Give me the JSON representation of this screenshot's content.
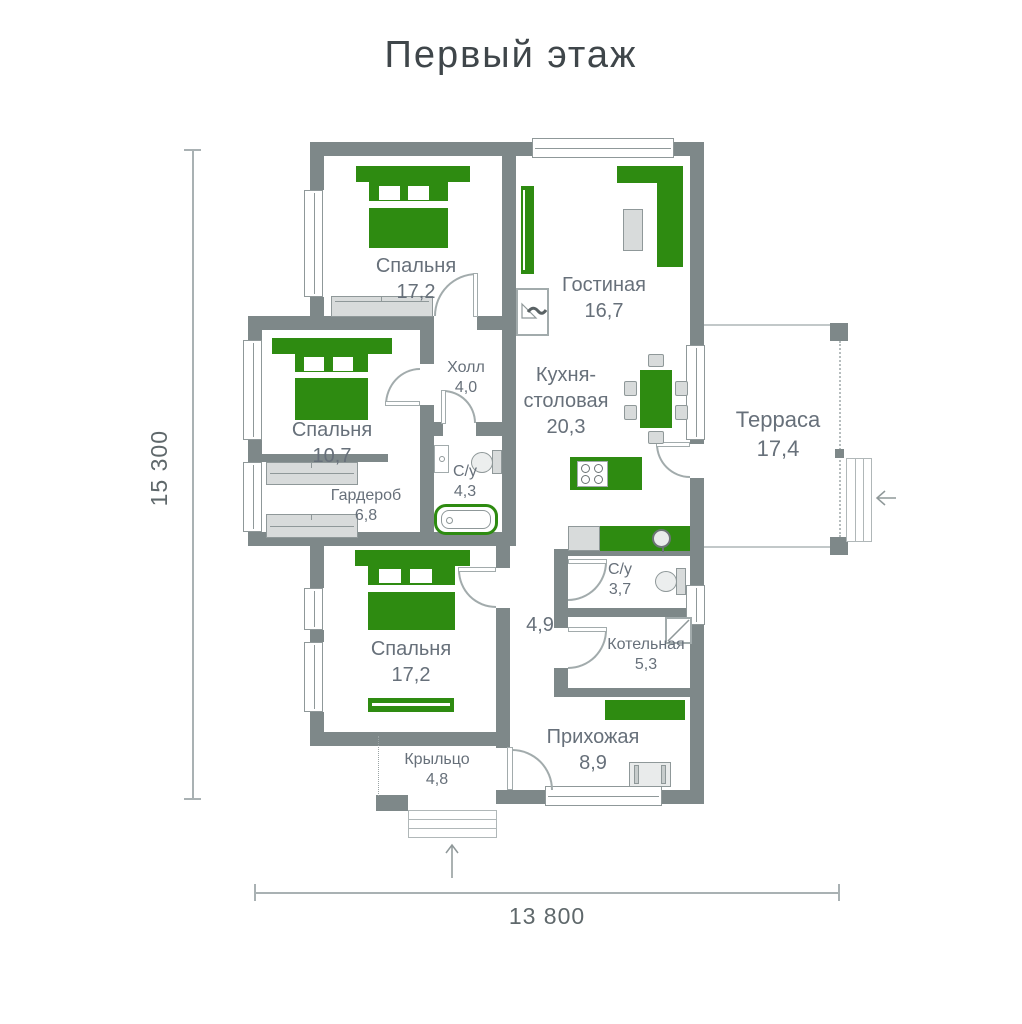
{
  "title": "Первый этаж",
  "dimensions": {
    "height_label": "15 300",
    "width_label": "13 800"
  },
  "rooms": [
    {
      "name": "Спальня",
      "area": "17,2"
    },
    {
      "name": "Гостиная",
      "area": "16,7"
    },
    {
      "name": "Холл",
      "area": "4,0"
    },
    {
      "name": "Кухня-столовая",
      "area": "20,3"
    },
    {
      "name": "Спальня",
      "area": "10,7"
    },
    {
      "name": "Гардероб",
      "area": "6,8"
    },
    {
      "name": "С/у",
      "area": "4,3"
    },
    {
      "name": "Спальня",
      "area": "17,2"
    },
    {
      "name": "Терраса",
      "area": "17,4"
    },
    {
      "name": "С/у",
      "area": "3,7"
    },
    {
      "name": "Котельная",
      "area": "5,3"
    },
    {
      "name": "",
      "area": "4,9"
    },
    {
      "name": "Прихожая",
      "area": "8,9"
    },
    {
      "name": "Крыльцо",
      "area": "4,8"
    }
  ],
  "colors": {
    "accent_green": "#2e8b11",
    "wall_gray": "#7e8889",
    "furniture_gray": "#d8dbdb",
    "text_gray": "#67707a"
  }
}
